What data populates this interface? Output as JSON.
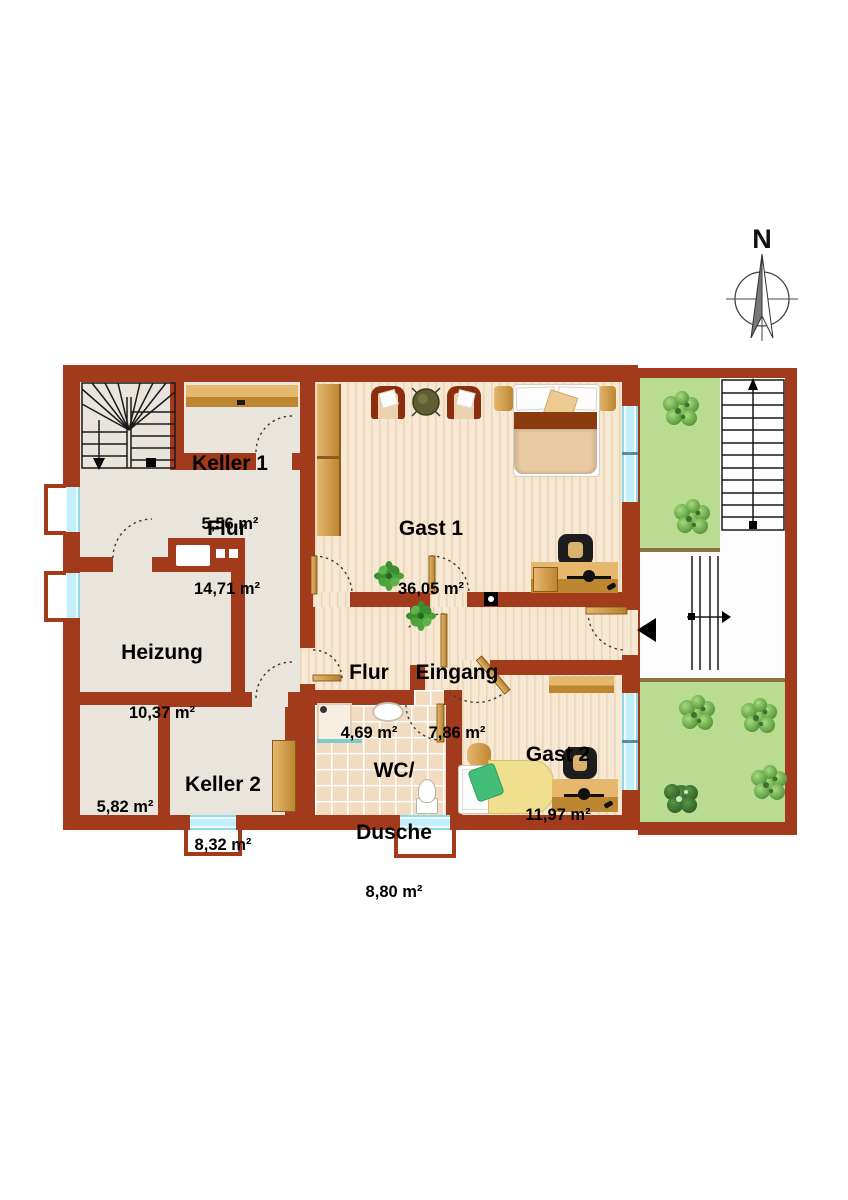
{
  "compass": {
    "north": "N"
  },
  "rooms": {
    "keller1": {
      "name": "Keller 1",
      "area": "5,56 m²"
    },
    "flur_main": {
      "name": "Flur",
      "area": "14,71 m²"
    },
    "heizung": {
      "name": "Heizung",
      "area": "10,37 m²"
    },
    "raum582": {
      "area": "5,82 m²"
    },
    "keller2": {
      "name": "Keller 2",
      "area": "8,32 m²"
    },
    "gast1": {
      "name": "Gast 1",
      "area": "36,05 m²"
    },
    "flur_small": {
      "name": "Flur",
      "area": "4,69 m²"
    },
    "eingang": {
      "name": "Eingang",
      "area": "7,86 m²"
    },
    "wc_dusche": {
      "name_line1": "WC/",
      "name_line2": "Dusche",
      "area": "8,80 m²"
    },
    "gast2": {
      "name": "Gast 2",
      "area": "11,97 m²"
    }
  },
  "colors": {
    "wall": "#a23a1c",
    "floor_gray": "#e9e5dd",
    "floor_wood": "#f6e8d2",
    "floor_tile": "#f1dcc2",
    "garden_green": "#b9dc92",
    "window_cyan": "#c2eff9",
    "furniture_wood": "#cf9a44",
    "accent_dark_red": "#8c2d0d"
  }
}
